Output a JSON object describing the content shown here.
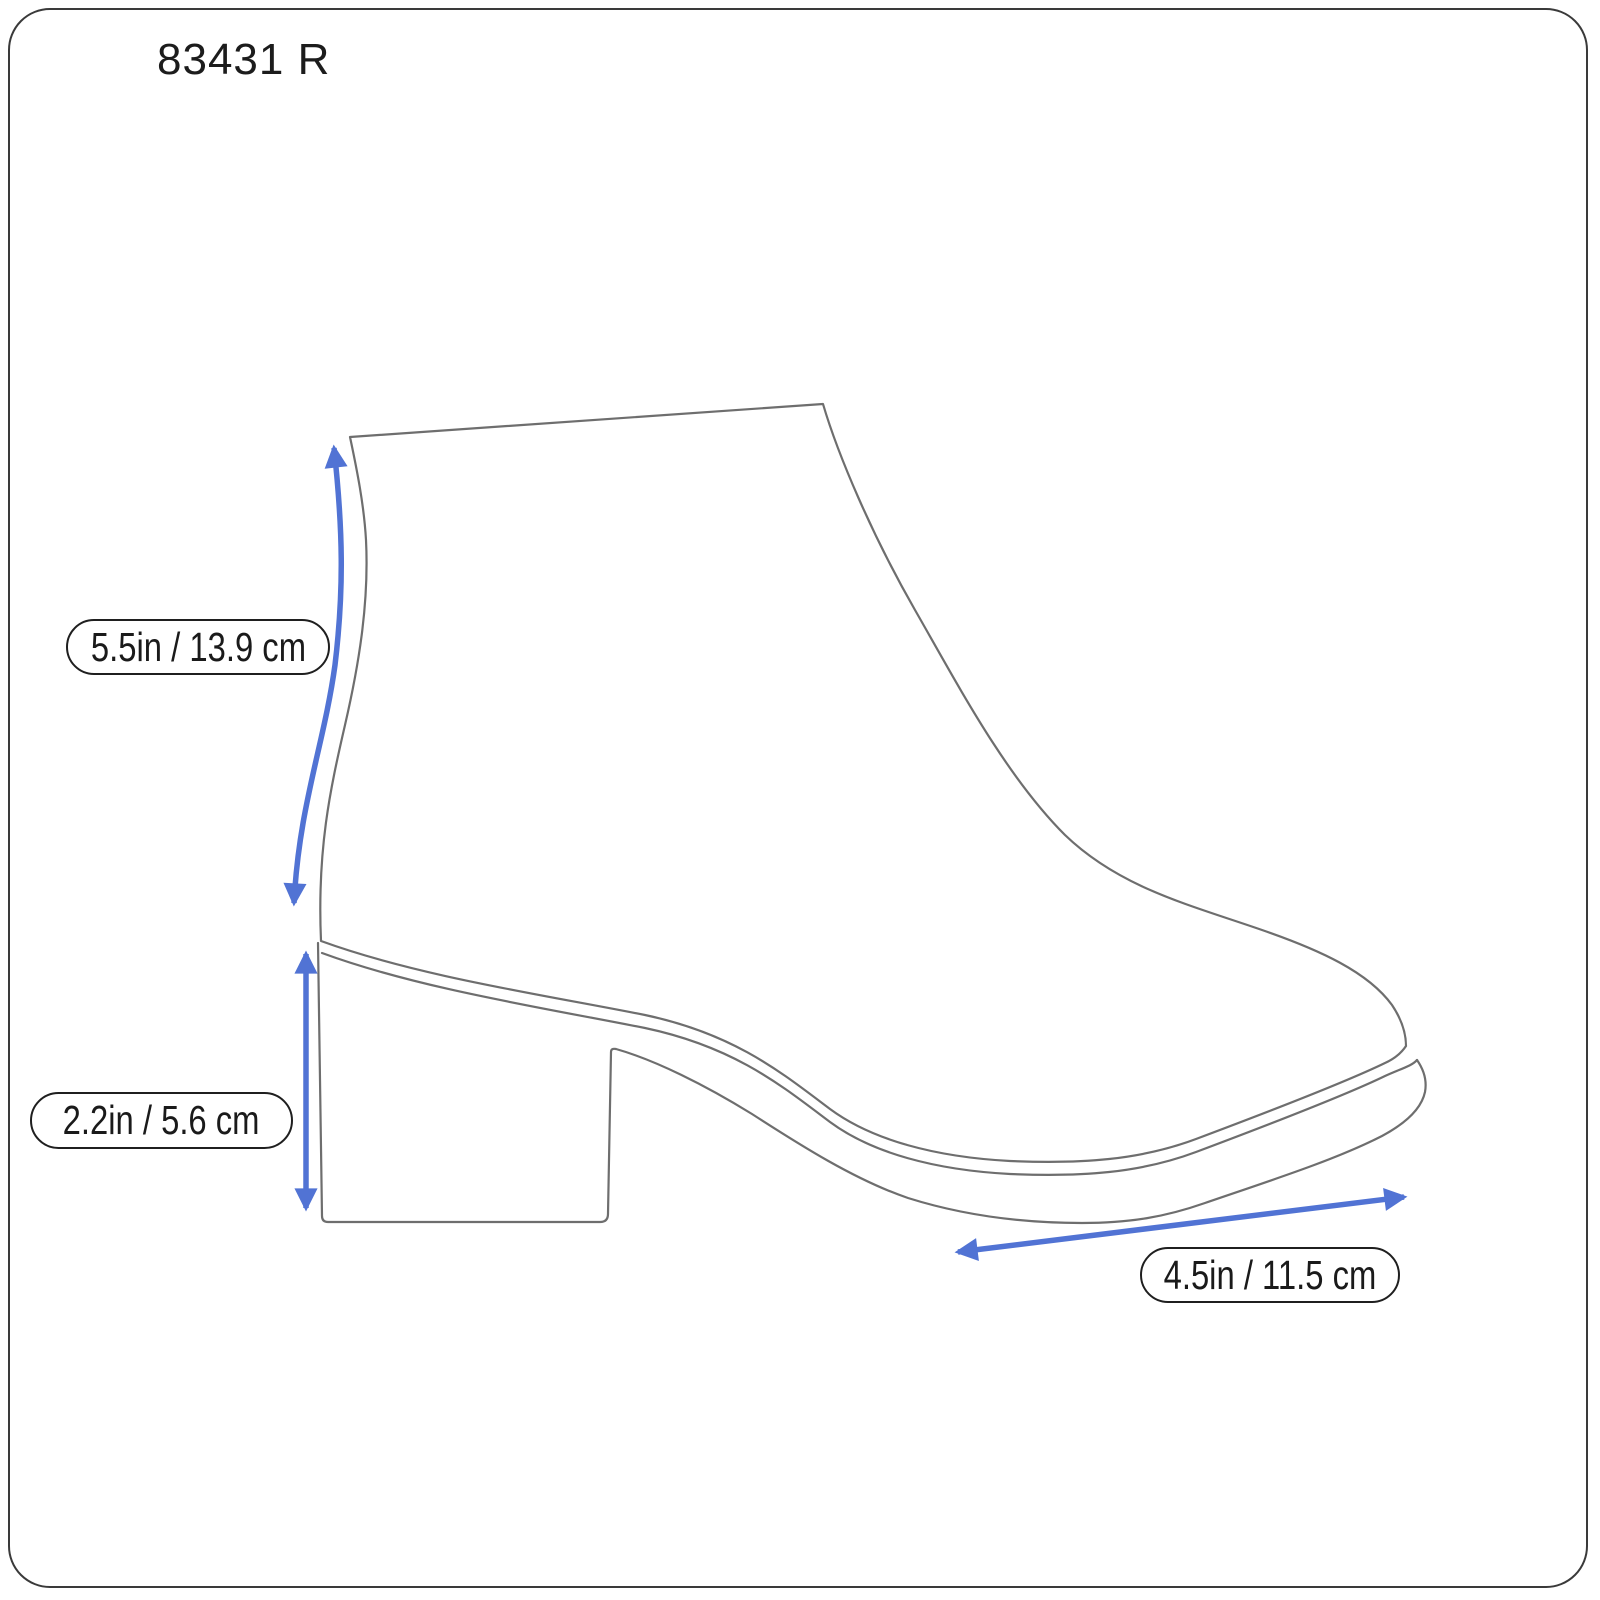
{
  "page": {
    "background": "#ffffff",
    "border_color": "#3a3a3a"
  },
  "header": {
    "model_number": "83431 R"
  },
  "diagram": {
    "subject": "ankle boot side view line drawing with measurement arrows",
    "line_color": "#6e6e6e",
    "arrow_color": "#5173d4",
    "label_border_color": "#1f1f1f",
    "measurements": [
      {
        "id": "shaft-height",
        "label": "5.5in / 13.9 cm"
      },
      {
        "id": "heel-height",
        "label": "2.2in / 5.6 cm"
      },
      {
        "id": "sole-length",
        "label": "4.5in / 11.5 cm"
      }
    ]
  }
}
